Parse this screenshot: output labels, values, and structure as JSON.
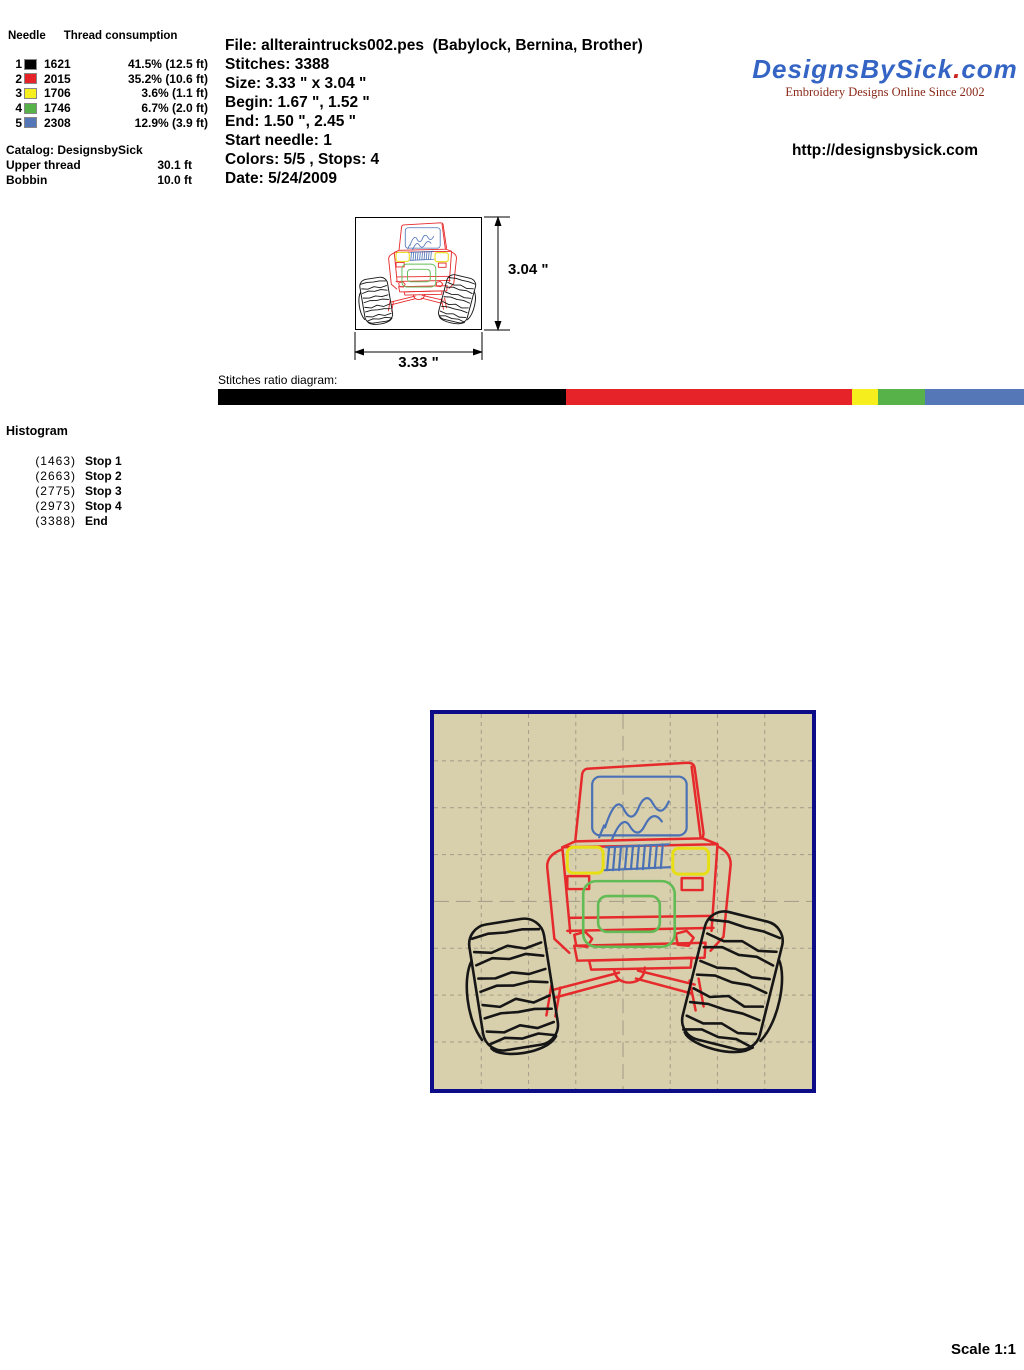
{
  "file_info": {
    "lines": [
      "File: allteraintrucks002.pes  (Babylock, Bernina, Brother)",
      "Stitches: 3388",
      "Size: 3.33 \" x 3.04 \"",
      "Begin: 1.67 \", 1.52 \"",
      "End: 1.50 \", 2.45 \"",
      "Start needle: 1",
      "Colors: 5/5 , Stops: 4",
      "Date: 5/24/2009"
    ]
  },
  "brand": {
    "logo_name": "DesignsBySick",
    "logo_dot": ".",
    "logo_tld": "com",
    "logo_color": "#3565c4",
    "dot_color": "#cc2222",
    "tagline": "Embroidery Designs Online Since 2002",
    "tagline_color": "#8b2a1a",
    "url": "http://designsbysick.com"
  },
  "consumption": {
    "col_needle": "Needle",
    "col_thread": "Thread consumption",
    "needles": [
      {
        "needle": "1",
        "color": "#000000",
        "stitches": "1621",
        "consumption": "41.5% (12.5 ft)"
      },
      {
        "needle": "2",
        "color": "#e62329",
        "stitches": "2015",
        "consumption": "35.2% (10.6 ft)"
      },
      {
        "needle": "3",
        "color": "#f7ee1e",
        "stitches": "1706",
        "consumption": "3.6% (1.1 ft)"
      },
      {
        "needle": "4",
        "color": "#58b24a",
        "stitches": "1746",
        "consumption": "6.7% (2.0 ft)"
      },
      {
        "needle": "5",
        "color": "#5577b8",
        "stitches": "2308",
        "consumption": "12.9% (3.9 ft)"
      }
    ],
    "catalog": "Catalog: DesignsbySick",
    "upper_thread_label": "Upper thread",
    "upper_thread_value": "30.1 ft",
    "bobbin_label": "Bobbin",
    "bobbin_value": "10.0 ft"
  },
  "design_dimensions": {
    "height_label": "3.04 \"",
    "width_label": "3.33 \""
  },
  "ratio_diagram": {
    "label": "Stitches ratio diagram:",
    "segments": [
      {
        "color": "#000000",
        "pct": 43.2
      },
      {
        "color": "#e62329",
        "pct": 35.4
      },
      {
        "color": "#f7ee1e",
        "pct": 3.3
      },
      {
        "color": "#58b24a",
        "pct": 5.8
      },
      {
        "color": "#5577b8",
        "pct": 12.3
      }
    ]
  },
  "histogram": {
    "title": "Histogram",
    "rows": [
      {
        "count": "(1463)",
        "label": "Stop 1"
      },
      {
        "count": "(2663)",
        "label": "Stop 2"
      },
      {
        "count": "(2775)",
        "label": "Stop 3"
      },
      {
        "count": "(2973)",
        "label": "Stop 4"
      },
      {
        "count": "(3388)",
        "label": "End"
      }
    ]
  },
  "preview": {
    "bg_color": "#d8cfad",
    "border_color": "#0c0c88",
    "grid_color": "#a7a08a"
  },
  "footer": {
    "scale_label": "Scale 1:1"
  }
}
